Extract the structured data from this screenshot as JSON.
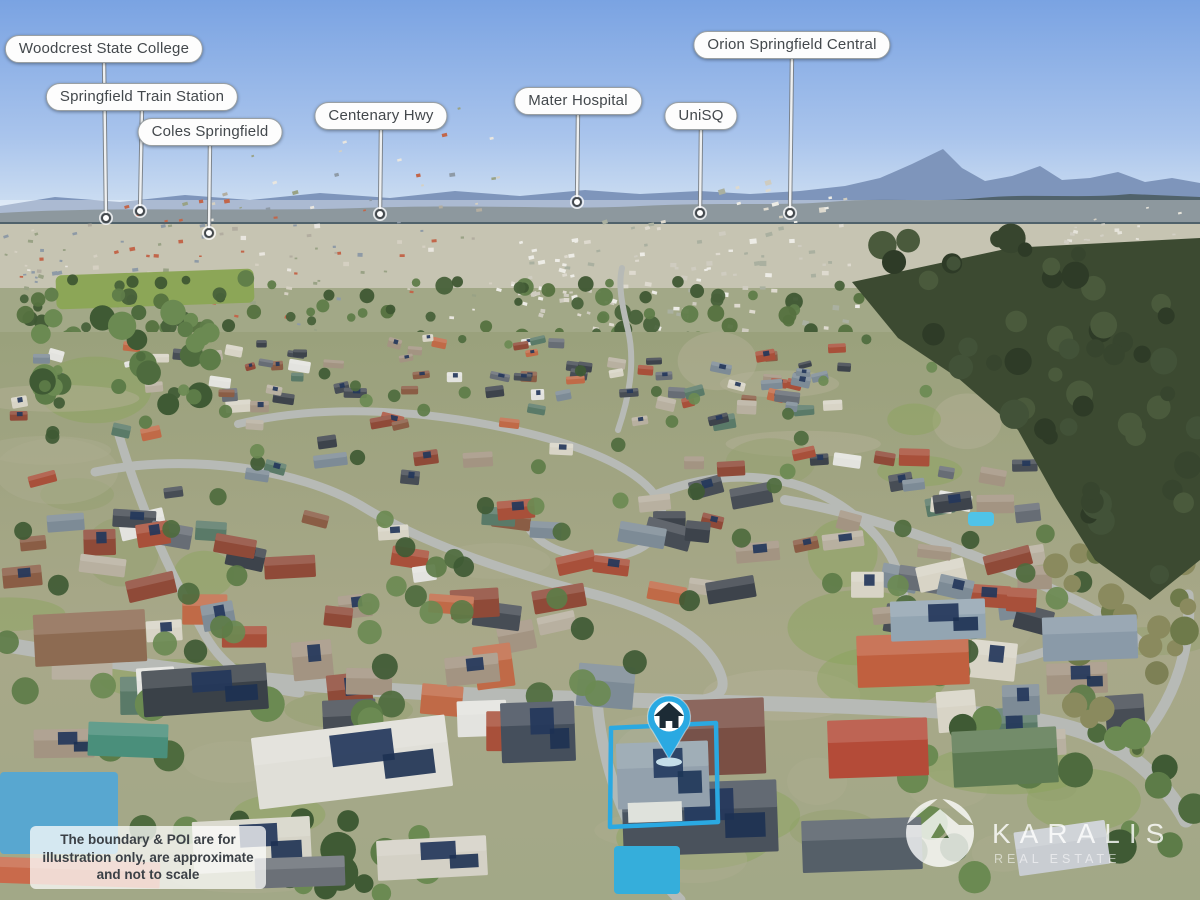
{
  "pois": [
    {
      "label": "Woodcrest State College",
      "cx": 104,
      "top": 35,
      "tx": 106,
      "ty": 218
    },
    {
      "label": "Springfield Train Station",
      "cx": 142,
      "top": 83,
      "tx": 140,
      "ty": 211
    },
    {
      "label": "Coles Springfield",
      "cx": 210,
      "top": 118,
      "tx": 209,
      "ty": 233
    },
    {
      "label": "Centenary Hwy",
      "cx": 381,
      "top": 102,
      "tx": 380,
      "ty": 214
    },
    {
      "label": "Mater Hospital",
      "cx": 578,
      "top": 87,
      "tx": 577,
      "ty": 202
    },
    {
      "label": "UniSQ",
      "cx": 701,
      "top": 102,
      "tx": 700,
      "ty": 213
    },
    {
      "label": "Orion Springfield Central",
      "cx": 792,
      "top": 31,
      "tx": 790,
      "ty": 213
    }
  ],
  "marker": {
    "x": 669,
    "y": 716.5,
    "tip_y": 759,
    "icon": "house-icon"
  },
  "boundary": {
    "points": "611,728 716,723 718,822 610,827",
    "color": "#2aa9e2"
  },
  "disclaimer": {
    "text": "The boundary & POI are for illustration only, are approximate and not to scale"
  },
  "watermark": {
    "brand": "KARALIS",
    "tagline": "REAL ESTATE"
  },
  "colors": {
    "marker_blue": "#2aa9e2",
    "marker_house": "#1c2b35",
    "pill_bg": "#fdfdfd",
    "pill_text": "#43484c",
    "leader_edge": "#74797d",
    "leader_core": "#eef0f1",
    "sky_top": "#7aa3e2",
    "sky_horizon": "#dce9f4"
  }
}
